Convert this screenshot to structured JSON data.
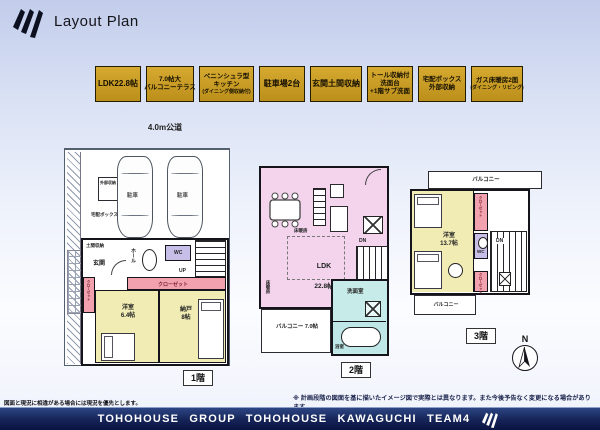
{
  "header": {
    "title": "Layout Plan"
  },
  "road_label": "4.0m公道",
  "badges": [
    {
      "line1": "LDK22.8帖"
    },
    {
      "line1": "7.0帖大",
      "line2": "バルコニーテラス"
    },
    {
      "line1": "ペニンシュラ型",
      "line2": "キッチン",
      "line3": "(ダイニング側収納付)"
    },
    {
      "line1": "駐車場2台"
    },
    {
      "line1": "玄関土間収納"
    },
    {
      "line1": "トール収納付",
      "line2": "洗面台",
      "line3": "+1階サブ洗面"
    },
    {
      "line1": "宅配ボックス",
      "line2": "外部収納"
    },
    {
      "line1": "ガス床暖房2面",
      "line2": "(ダイニング・リビング)"
    }
  ],
  "floor1": {
    "name": "1階",
    "parking1": "駐車",
    "parking2": "駐車",
    "ext_storage": "外部収納",
    "delivery_box": "宅配ボックス",
    "doma_storage": "土間収納",
    "entrance": "玄関",
    "hall": "ホール",
    "wc": "WC",
    "up": "UP",
    "closet_main": "クローゼット",
    "closet_side": "クローゼット",
    "room1_name": "洋室",
    "room1_size": "6.4帖",
    "room2_name": "納戸",
    "room2_size": "8帖"
  },
  "floor2": {
    "name": "2階",
    "ldk_name": "LDK",
    "ldk_size": "22.8帖",
    "floor_heating1": "床暖房",
    "floor_heating2": "床暖房",
    "dn": "DN",
    "up": "UP",
    "washroom": "洗面室",
    "bathroom": "浴室",
    "balcony_name": "バルコニー",
    "balcony_size": "7.0帖"
  },
  "floor3": {
    "name": "3階",
    "balcony_top": "バルコニー",
    "room_name": "洋室",
    "room_size": "13.7帖",
    "closet_top": "クローゼット",
    "wc": "WC",
    "dn": "DN",
    "closet_bottom": "クローゼット",
    "balcony_bottom": "バルコニー"
  },
  "compass": {
    "north": "N"
  },
  "notes": {
    "left": "図面と現況に相違がある場合には現況を優先とします。",
    "right": "※ 計画段階の図面を基に描いたイメージ図で実際とは異なります。また今後予告なく変更になる場合があります。"
  },
  "footer": {
    "brand": "TOHOHOUSE GROUP TOHOHOUSE KAWAGUCHI TEAM4"
  },
  "colors": {
    "badge_gold": "#c89b28",
    "room_yellow": "#f0ecb4",
    "ldk_pink": "#f3d4ec",
    "closet_pink": "#f2a2ae",
    "wc_purple": "#c8bfe8",
    "bath_cyan": "#c6ebe8",
    "footer_navy": "#13204f",
    "background_top": "#c2cdeb"
  }
}
